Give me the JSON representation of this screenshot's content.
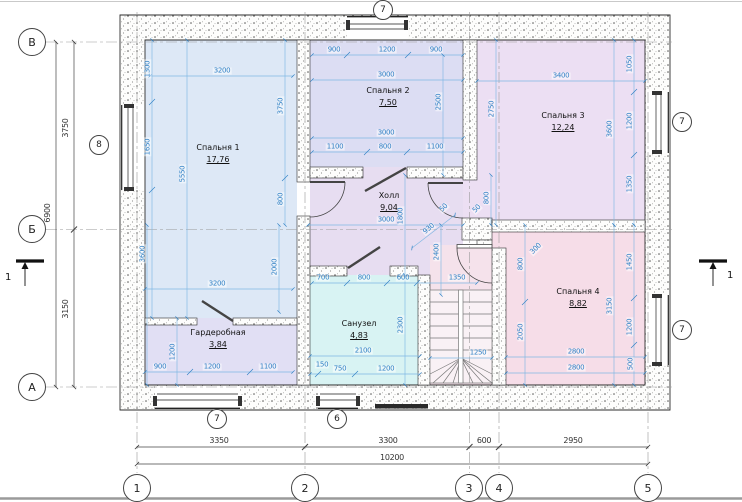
{
  "colors": {
    "bedroom1": "#dde8f6",
    "bedroom2": "#dcddf3",
    "bedroom3": "#ecdff3",
    "bedroom4": "#f6dde8",
    "hall": "#e7ddf1",
    "bathroom": "#d8f3f3",
    "wardrobe": "#e1dff4",
    "landing": "#f5e2eb",
    "dim_blue": "#2e7fc4",
    "wall_stroke": "#2e2e2e"
  },
  "rooms": [
    {
      "name": "Спальня 1",
      "area": "17,76",
      "x": 218,
      "y": 154
    },
    {
      "name": "Спальня 2",
      "area": "7,50",
      "x": 388,
      "y": 97
    },
    {
      "name": "Спальня 3",
      "area": "12,24",
      "x": 563,
      "y": 122
    },
    {
      "name": "Спальня 4",
      "area": "8,82",
      "x": 578,
      "y": 298
    },
    {
      "name": "Холл",
      "area": "9,04",
      "x": 389,
      "y": 202
    },
    {
      "name": "Санузел",
      "area": "4,83",
      "x": 359,
      "y": 330
    },
    {
      "name": "Гардеробная",
      "area": "3,84",
      "x": 218,
      "y": 339
    }
  ],
  "axis_circles": [
    {
      "label": "1",
      "x": 137,
      "y": 488
    },
    {
      "label": "2",
      "x": 305,
      "y": 488
    },
    {
      "label": "3",
      "x": 469,
      "y": 488
    },
    {
      "label": "4",
      "x": 499,
      "y": 488
    },
    {
      "label": "5",
      "x": 648,
      "y": 488
    },
    {
      "label": "В",
      "x": 32,
      "y": 42
    },
    {
      "label": "Б",
      "x": 32,
      "y": 229
    },
    {
      "label": "А",
      "x": 32,
      "y": 387
    }
  ],
  "window_circles": [
    {
      "label": "7",
      "x": 383,
      "y": 10
    },
    {
      "label": "8",
      "x": 99,
      "y": 145
    },
    {
      "label": "7",
      "x": 682,
      "y": 122
    },
    {
      "label": "7",
      "x": 682,
      "y": 330
    },
    {
      "label": "7",
      "x": 217,
      "y": 419
    },
    {
      "label": "6",
      "x": 337,
      "y": 419
    }
  ],
  "section_markers": [
    {
      "label": "1"
    },
    {
      "label": "1"
    }
  ],
  "dim_labels": [
    {
      "t": "3350",
      "x": 219,
      "y": 441,
      "k": "e"
    },
    {
      "t": "3300",
      "x": 388,
      "y": 441,
      "k": "e"
    },
    {
      "t": "600",
      "x": 484,
      "y": 441,
      "k": "e"
    },
    {
      "t": "2950",
      "x": 573,
      "y": 441,
      "k": "e"
    },
    {
      "t": "10200",
      "x": 392,
      "y": 458,
      "k": "e"
    },
    {
      "t": "3750",
      "x": 66,
      "y": 128,
      "r": -90,
      "k": "e"
    },
    {
      "t": "3150",
      "x": 66,
      "y": 309,
      "r": -90,
      "k": "e"
    },
    {
      "t": "6900",
      "x": 48,
      "y": 213,
      "r": -90,
      "k": "e"
    },
    {
      "t": "3200",
      "x": 222,
      "y": 71
    },
    {
      "t": "900",
      "x": 334,
      "y": 50
    },
    {
      "t": "1200",
      "x": 387,
      "y": 50
    },
    {
      "t": "900",
      "x": 436,
      "y": 50
    },
    {
      "t": "3000",
      "x": 386,
      "y": 75
    },
    {
      "t": "3400",
      "x": 561,
      "y": 76
    },
    {
      "t": "3000",
      "x": 386,
      "y": 133
    },
    {
      "t": "1100",
      "x": 335,
      "y": 147
    },
    {
      "t": "800",
      "x": 385,
      "y": 147
    },
    {
      "t": "1100",
      "x": 435,
      "y": 147
    },
    {
      "t": "3000",
      "x": 386,
      "y": 220
    },
    {
      "t": "1350",
      "x": 457,
      "y": 278
    },
    {
      "t": "700",
      "x": 323,
      "y": 278
    },
    {
      "t": "800",
      "x": 364,
      "y": 278
    },
    {
      "t": "600",
      "x": 403,
      "y": 278
    },
    {
      "t": "3200",
      "x": 217,
      "y": 284
    },
    {
      "t": "2100",
      "x": 363,
      "y": 351
    },
    {
      "t": "150",
      "x": 322,
      "y": 365
    },
    {
      "t": "750",
      "x": 340,
      "y": 369
    },
    {
      "t": "1200",
      "x": 386,
      "y": 369
    },
    {
      "t": "1250",
      "x": 478,
      "y": 353
    },
    {
      "t": "2800",
      "x": 576,
      "y": 352
    },
    {
      "t": "2800",
      "x": 576,
      "y": 368
    },
    {
      "t": "900",
      "x": 160,
      "y": 367
    },
    {
      "t": "1200",
      "x": 212,
      "y": 367
    },
    {
      "t": "1100",
      "x": 268,
      "y": 367
    },
    {
      "t": "1300",
      "x": 148,
      "y": 69,
      "r": -90
    },
    {
      "t": "1650",
      "x": 148,
      "y": 147,
      "r": -90
    },
    {
      "t": "5550",
      "x": 183,
      "y": 174,
      "r": -90
    },
    {
      "t": "3750",
      "x": 281,
      "y": 106,
      "r": -90
    },
    {
      "t": "800",
      "x": 281,
      "y": 199,
      "r": -90
    },
    {
      "t": "3600",
      "x": 143,
      "y": 254,
      "r": -90
    },
    {
      "t": "2000",
      "x": 275,
      "y": 267,
      "r": -90
    },
    {
      "t": "1200",
      "x": 173,
      "y": 352,
      "r": -90
    },
    {
      "t": "2500",
      "x": 439,
      "y": 102,
      "r": -90
    },
    {
      "t": "2750",
      "x": 492,
      "y": 109,
      "r": -90
    },
    {
      "t": "1050",
      "x": 630,
      "y": 64,
      "r": -90
    },
    {
      "t": "3600",
      "x": 610,
      "y": 129,
      "r": -90
    },
    {
      "t": "1200",
      "x": 630,
      "y": 121,
      "r": -90
    },
    {
      "t": "1350",
      "x": 630,
      "y": 184,
      "r": -90
    },
    {
      "t": "800",
      "x": 487,
      "y": 198,
      "r": -90
    },
    {
      "t": "1800",
      "x": 401,
      "y": 216,
      "r": -90
    },
    {
      "t": "2400",
      "x": 437,
      "y": 252,
      "r": -90
    },
    {
      "t": "800",
      "x": 521,
      "y": 264,
      "r": -90
    },
    {
      "t": "2300",
      "x": 401,
      "y": 325,
      "r": -90
    },
    {
      "t": "1450",
      "x": 630,
      "y": 262,
      "r": -90
    },
    {
      "t": "3150",
      "x": 610,
      "y": 306,
      "r": -90
    },
    {
      "t": "2050",
      "x": 521,
      "y": 332,
      "r": -90
    },
    {
      "t": "1200",
      "x": 630,
      "y": 327,
      "r": -90
    },
    {
      "t": "500",
      "x": 631,
      "y": 364,
      "r": -90
    },
    {
      "t": "930",
      "x": 429,
      "y": 229,
      "r": -40
    },
    {
      "t": "50",
      "x": 444,
      "y": 208,
      "r": -45
    },
    {
      "t": "50",
      "x": 477,
      "y": 209,
      "r": -45
    },
    {
      "t": "300",
      "x": 536,
      "y": 249,
      "r": -45
    }
  ]
}
